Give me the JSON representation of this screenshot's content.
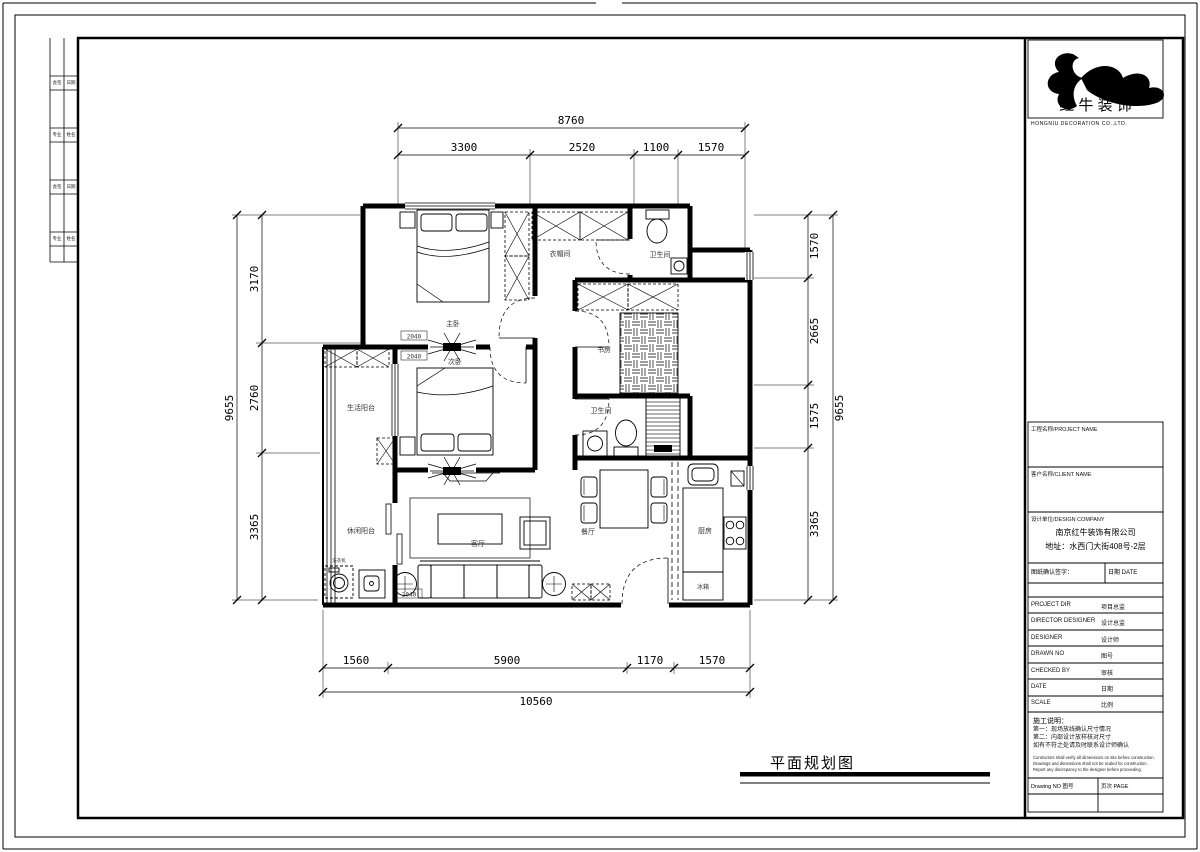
{
  "sheet": {
    "title": "平面规划图",
    "logo": {
      "name_cn": "红 牛 装 饰",
      "name_sub": "HONGNIU DECORATION CO.,LTD."
    },
    "strip_labels": [
      "会签",
      "日期",
      "专业",
      "姓名",
      "会签",
      "日期",
      "专业",
      "姓名"
    ],
    "title_block": {
      "field_boxes": [
        "工程名称/PROJECT NAME",
        "客户名称/CLIENT NAME",
        "设计单位/DESIGN COMPANY"
      ],
      "company_lines": [
        "南京红牛装饰有限公司",
        "地址：水西门大街408号-2层"
      ],
      "confirm_row": {
        "left": "图纸确认签字：",
        "right": "日期 DATE"
      },
      "rows": [
        {
          "en": "PROJECT DIR",
          "cn": "项目总监"
        },
        {
          "en": "DIRECTOR DESIGNER",
          "cn": "设计总监"
        },
        {
          "en": "DESIGNER",
          "cn": "设计师"
        },
        {
          "en": "DRAWN NO",
          "cn": "图号"
        },
        {
          "en": "CHECKED BY",
          "cn": "审核"
        },
        {
          "en": "DATE",
          "cn": "日期"
        },
        {
          "en": "SCALE",
          "cn": "比例"
        }
      ],
      "notes": {
        "title": "施工说明：",
        "cn": [
          "第一：现场放线确认尺寸情况",
          "第二：内部设计放样核对尺寸",
          "如有不符之处请及时联系设计师确认"
        ],
        "en": [
          "Contractors shall verify all dimensions on site before construction.",
          "Drawings and dimensions shall not be scaled for construction.",
          "Report any discrepancy to the designer before proceeding."
        ]
      },
      "footer": {
        "left": "Drawing NO 图号",
        "right": "页次 PAGE"
      }
    }
  },
  "plan": {
    "rooms": {
      "master": "主卧",
      "cloak": "衣帽间",
      "wc": "卫生间",
      "bed2": "次卧",
      "study": "书房",
      "bath": "卫生间",
      "balcony_top": "生活阳台",
      "balcony_bottom": "休闲阳台",
      "living": "客厅",
      "dining": "餐厅",
      "kitchen": "厨房",
      "fridge": "冰箱",
      "washer": "洗衣机"
    },
    "tags": {
      "door_tag": "2040"
    },
    "dimensions": {
      "top": {
        "total": "8760",
        "segments": [
          "3300",
          "2520",
          "1100",
          "1570"
        ]
      },
      "bottom": {
        "total": "10560",
        "segments": [
          "1560",
          "5900",
          "1170",
          "1570"
        ]
      },
      "left": {
        "total": "9655",
        "segments": [
          "3170",
          "2760",
          "3365"
        ]
      },
      "right": {
        "total": "9655",
        "segments": [
          "1570",
          "2665",
          "1575",
          "3365"
        ]
      }
    }
  }
}
